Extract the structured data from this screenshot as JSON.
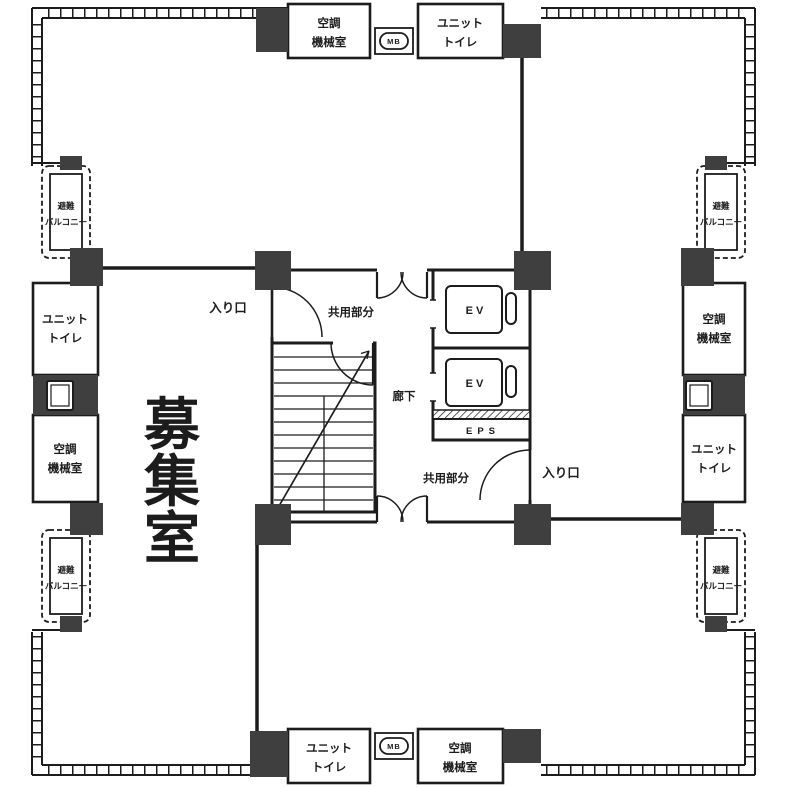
{
  "colors": {
    "line": "#1c1c1c",
    "column": "#3f3f3f",
    "background": "#ffffff"
  },
  "labels": {
    "vacant_room": {
      "text": "募集室",
      "chars": [
        "募",
        "集",
        "室"
      ]
    },
    "hvac_room": {
      "line1": "空調",
      "line2": "機械室"
    },
    "unit_toilet": {
      "line1": "ユニット",
      "line2": "トイレ"
    },
    "evac_balcony": {
      "line1": "避難",
      "line2": "バルコニー"
    },
    "common_area": "共用部分",
    "corridor": "廊下",
    "entrance": "入り口",
    "elevator": "EV",
    "eps": "EPS",
    "meter_box": "MB"
  }
}
